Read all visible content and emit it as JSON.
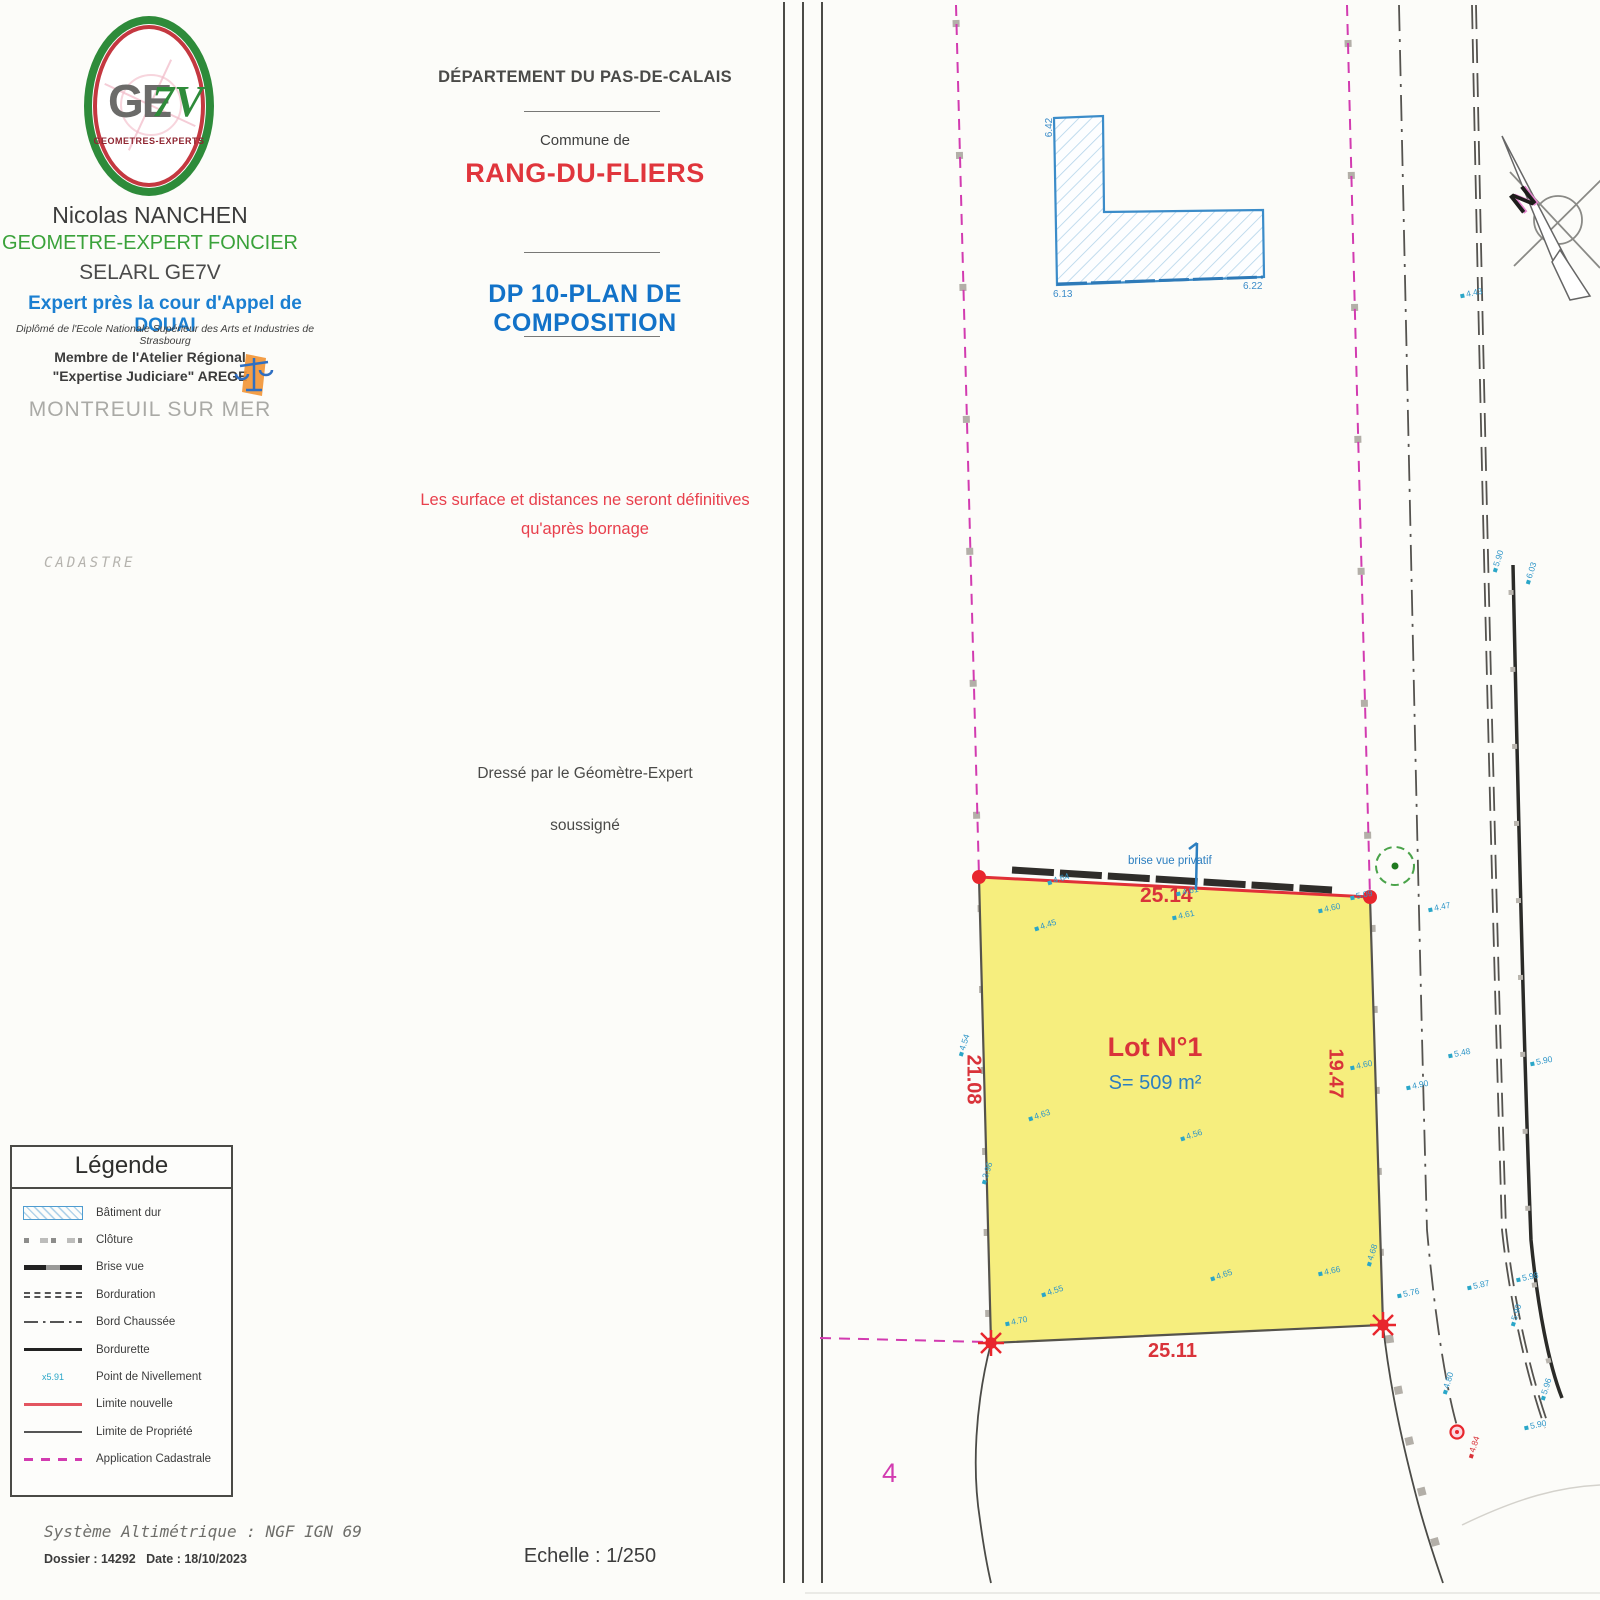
{
  "header": {
    "logo": {
      "ge": "GE",
      "sevenv": "7V",
      "subtitle": "GEOMETRES-EXPERTS"
    },
    "surveyor_name": "Nicolas NANCHEN",
    "surveyor_title": "GEOMETRE-EXPERT FONCIER",
    "company": "SELARL GE7V",
    "expert_line": "Expert  près la cour d'Appel de DOUAI",
    "diploma_line": "Diplômé de l'Ecole Nationale Supérieur des Arts et Industries de Strasbourg",
    "member_line1": "Membre de l'Atelier Régional",
    "member_line2": "\"Expertise Judiciare\" AREGE",
    "city": "MONTREUIL SUR MER",
    "cadastre_label": "CADASTRE"
  },
  "title_block": {
    "department": "DÉPARTEMENT DU PAS-DE-CALAIS",
    "commune_prefix": "Commune de",
    "commune": "RANG-DU-FLIERS",
    "plan_title": "DP 10-PLAN DE COMPOSITION",
    "warning_line1": "Les surface et distances ne seront définitives",
    "warning_line2": "qu'après bornage",
    "drafted_line1": "Dressé par le Géomètre-Expert",
    "drafted_line2": "soussigné",
    "scale_label": "Echelle : 1/250"
  },
  "footer": {
    "altimetric_system": "Système Altimétrique : NGF IGN 69",
    "dossier_label": "Dossier : 14292",
    "date_label": "Date : 18/10/2023"
  },
  "legend": {
    "title": "Légende",
    "items": [
      {
        "label": "Bâtiment dur",
        "type": "batiment-dur"
      },
      {
        "label": "Clôture",
        "type": "cloture"
      },
      {
        "label": "Brise vue",
        "type": "brise-vue"
      },
      {
        "label": "Borduration",
        "type": "borduration"
      },
      {
        "label": "Bord Chaussée",
        "type": "bord-chaussee"
      },
      {
        "label": "Bordurette",
        "type": "bordurette"
      },
      {
        "label": "Point de Nivellement",
        "type": "point-de-nivellement",
        "marker": "x5.91"
      },
      {
        "label": "Limite nouvelle",
        "type": "limite-nouvelle"
      },
      {
        "label": "Limite de Propriété",
        "type": "limite-de-propriete"
      },
      {
        "label": "Application Cadastrale",
        "type": "application-cadastrale"
      }
    ]
  },
  "map": {
    "lot": {
      "name": "Lot N°1",
      "area": "S= 509 m²",
      "dim_top": "25.14",
      "dim_left": "21.08",
      "dim_right": "19.47",
      "dim_bottom": "25.11",
      "top_edge_label": "brise vue privatif"
    },
    "building": {
      "elev_left": "6.42",
      "elev_bottom_left": "6.13",
      "elev_bottom_right": "6.22"
    },
    "parcel_number": "4",
    "north_label": "N",
    "red_point_label": {
      "x": 1462,
      "y": 1442,
      "t": "4.84",
      "r": -72
    },
    "elevation_points": [
      {
        "x": 1047,
        "y": 874,
        "t": "4.64",
        "r": -18
      },
      {
        "x": 1176,
        "y": 886,
        "t": "4.61",
        "r": -12
      },
      {
        "x": 1172,
        "y": 910,
        "t": "4.61",
        "r": -12
      },
      {
        "x": 1034,
        "y": 920,
        "t": "4.45",
        "r": -18
      },
      {
        "x": 1318,
        "y": 903,
        "t": "4.60",
        "r": -12
      },
      {
        "x": 1350,
        "y": 890,
        "t": "5.09",
        "r": -12
      },
      {
        "x": 1428,
        "y": 902,
        "t": "4.47",
        "r": -12
      },
      {
        "x": 1460,
        "y": 288,
        "t": "4.43",
        "r": -12
      },
      {
        "x": 952,
        "y": 1040,
        "t": "4.54",
        "r": -72
      },
      {
        "x": 975,
        "y": 1168,
        "t": "3.96",
        "r": -72
      },
      {
        "x": 1028,
        "y": 1110,
        "t": "4.63",
        "r": -18
      },
      {
        "x": 1180,
        "y": 1130,
        "t": "4.56",
        "r": -18
      },
      {
        "x": 1350,
        "y": 1060,
        "t": "4.60",
        "r": -12
      },
      {
        "x": 1406,
        "y": 1080,
        "t": "4.90",
        "r": -12
      },
      {
        "x": 1448,
        "y": 1048,
        "t": "5.48",
        "r": -12
      },
      {
        "x": 1530,
        "y": 1056,
        "t": "5.90",
        "r": -12
      },
      {
        "x": 1486,
        "y": 556,
        "t": "5.90",
        "r": -72
      },
      {
        "x": 1519,
        "y": 568,
        "t": "6.03",
        "r": -72
      },
      {
        "x": 1041,
        "y": 1286,
        "t": "4.55",
        "r": -18
      },
      {
        "x": 1210,
        "y": 1270,
        "t": "4.65",
        "r": -18
      },
      {
        "x": 1318,
        "y": 1266,
        "t": "4.66",
        "r": -12
      },
      {
        "x": 1360,
        "y": 1250,
        "t": "4.68",
        "r": -72
      },
      {
        "x": 1005,
        "y": 1316,
        "t": "4.70",
        "r": -12
      },
      {
        "x": 1397,
        "y": 1288,
        "t": "5.76",
        "r": -12
      },
      {
        "x": 1467,
        "y": 1280,
        "t": "5.87",
        "r": -12
      },
      {
        "x": 1516,
        "y": 1272,
        "t": "5.98",
        "r": -12
      },
      {
        "x": 1504,
        "y": 1310,
        "t": "5.90",
        "r": -72
      },
      {
        "x": 1436,
        "y": 1378,
        "t": "4.80",
        "r": -72
      },
      {
        "x": 1534,
        "y": 1384,
        "t": "5.96",
        "r": -72
      },
      {
        "x": 1524,
        "y": 1420,
        "t": "5.90",
        "r": -12
      }
    ]
  },
  "colors": {
    "red": "#d9333a",
    "blue": "#1b7fd1",
    "green": "#3aa23a",
    "magenta": "#d23bb0",
    "lot_yellow": "#f6ee7e",
    "building_blue": "#3b8cc9"
  }
}
